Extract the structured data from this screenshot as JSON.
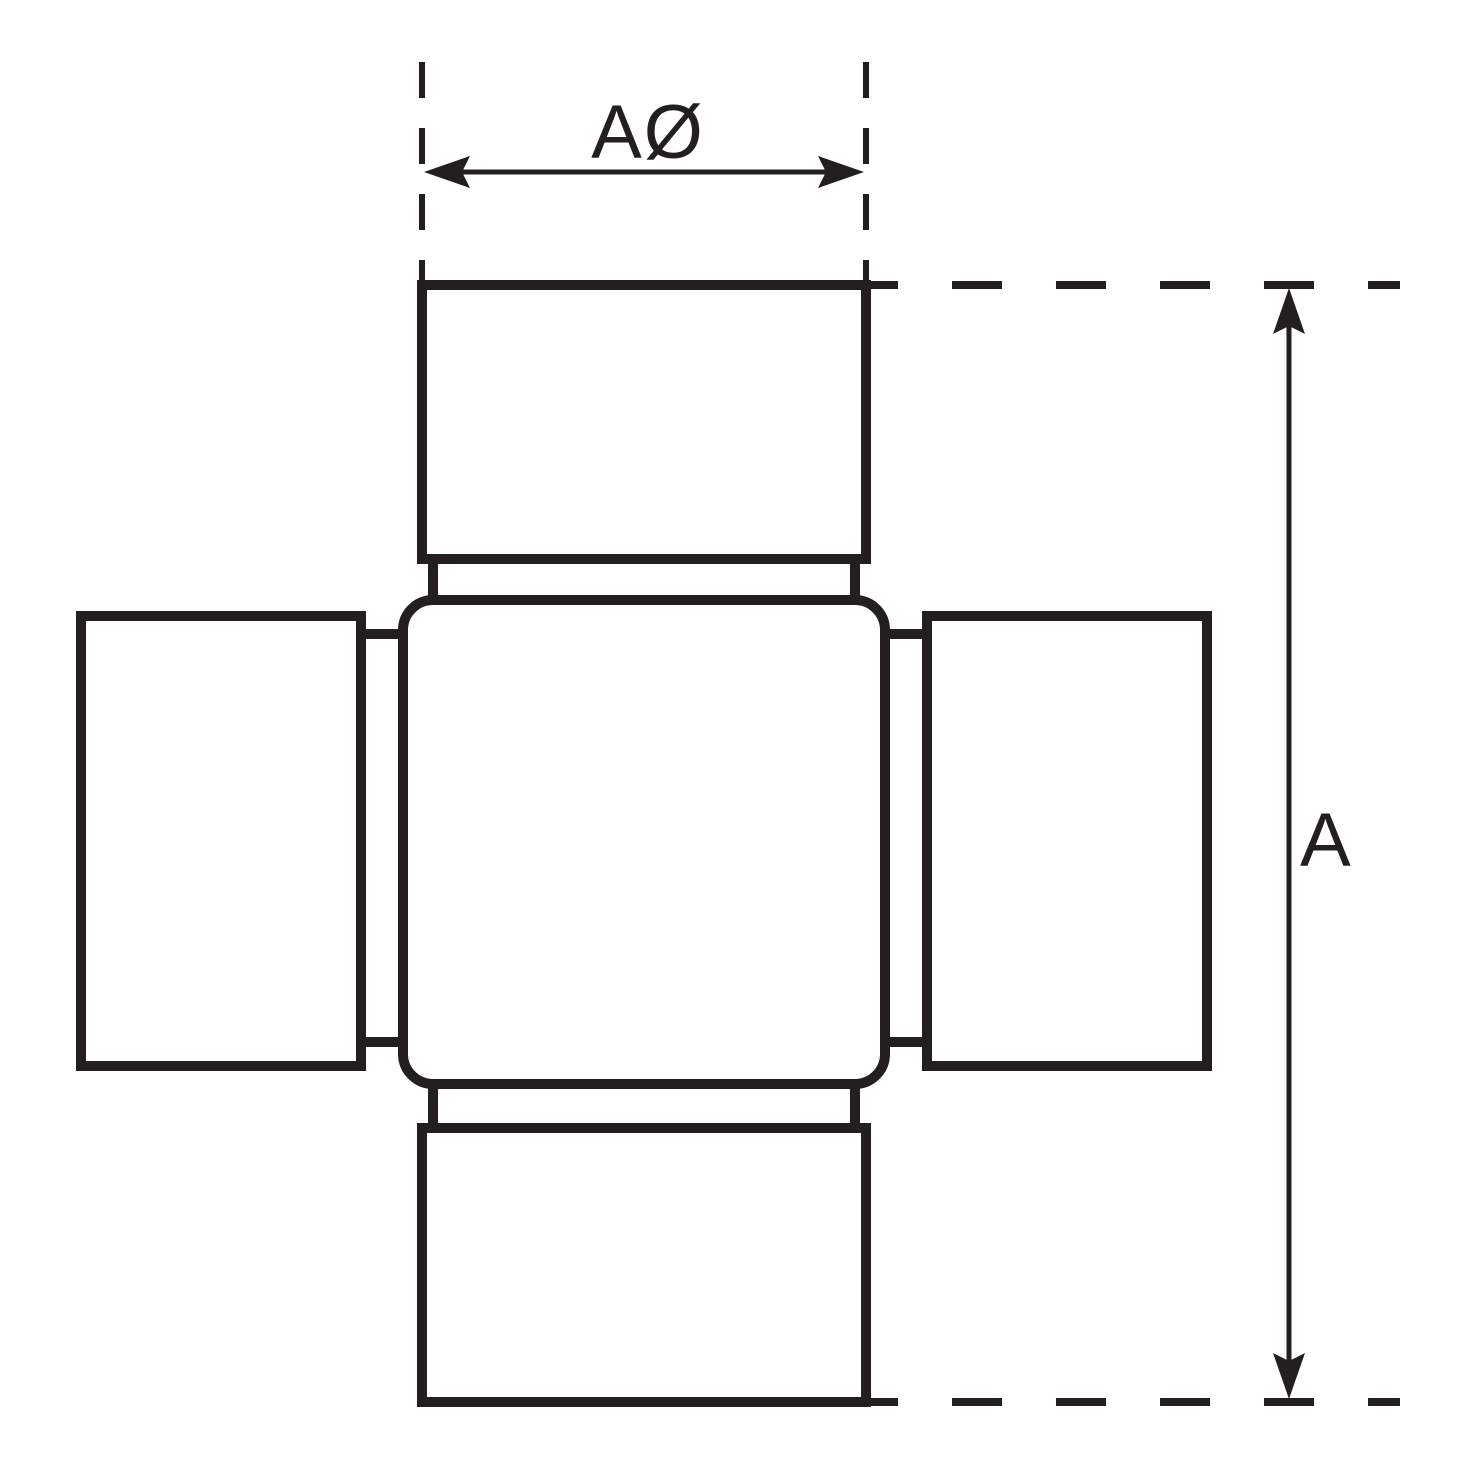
{
  "diagram": {
    "type": "technical-dimension-drawing",
    "subject": "universal-joint-cross",
    "background_color": "#ffffff",
    "line_color": "#231f20",
    "dimensions": {
      "width_label": "AØ",
      "length_label": "A"
    }
  }
}
